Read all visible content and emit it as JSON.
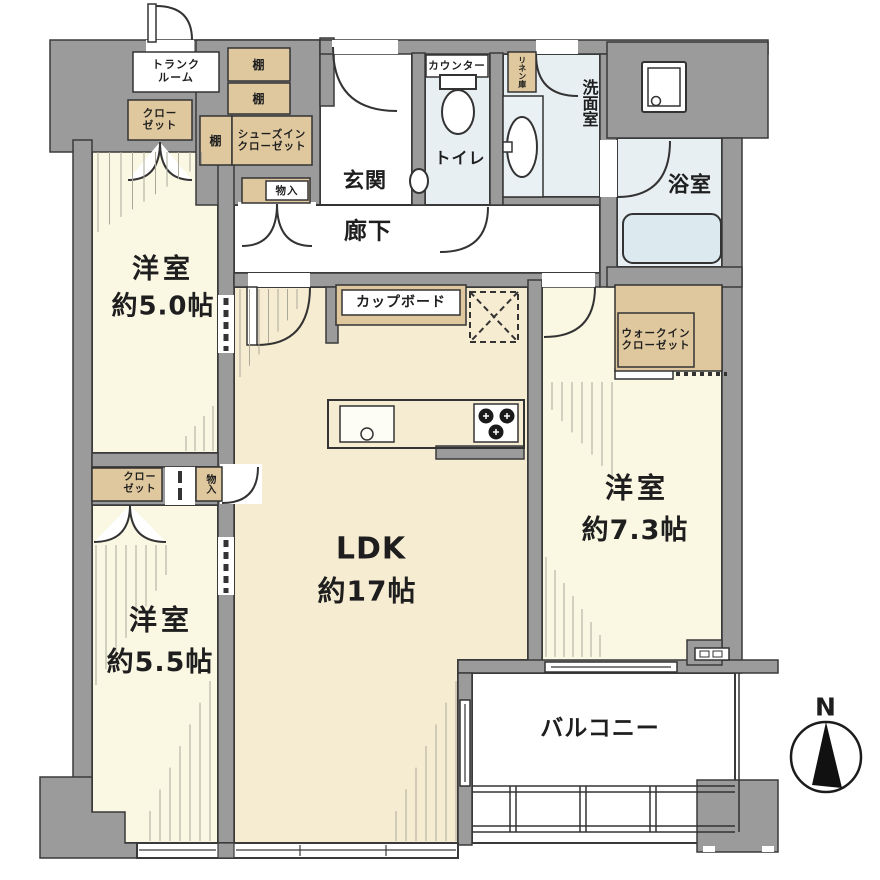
{
  "labels": {
    "trunk_line1": "トランク",
    "trunk_line2": "ルーム",
    "shelf": "棚",
    "shoes_closet_line1": "シューズイン",
    "shoes_closet_line2": "クローゼット",
    "closet_line1": "クロー",
    "closet_line2": "ゼット",
    "storage": "物入",
    "linen": "リネン庫",
    "toilet_counter": "カウンター",
    "toilet": "トイレ",
    "washroom": "洗面室",
    "bathroom": "浴室",
    "entrance": "玄関",
    "hallway": "廊下",
    "cupboard": "カップボード",
    "wic_line1": "ウォークイン",
    "wic_line2": "クローゼット",
    "west50_name": "洋室",
    "west50_area": "約5.0帖",
    "west55_name": "洋室",
    "west55_area": "約5.5帖",
    "west73_name": "洋室",
    "west73_area": "約7.3帖",
    "ldk_name": "LDK",
    "ldk_area": "約17帖",
    "balcony": "バルコニー",
    "compass_north": "N"
  },
  "colors": {
    "wall": "#9B9B9B",
    "outline": "#3a3a3a",
    "room_cream": "#FAF7E3",
    "ldk_cream": "#F6ECD2",
    "storage_tan": "#DFC89E",
    "wet_blue": "#E8EFF2",
    "tub_blue": "#DCE9EF"
  }
}
